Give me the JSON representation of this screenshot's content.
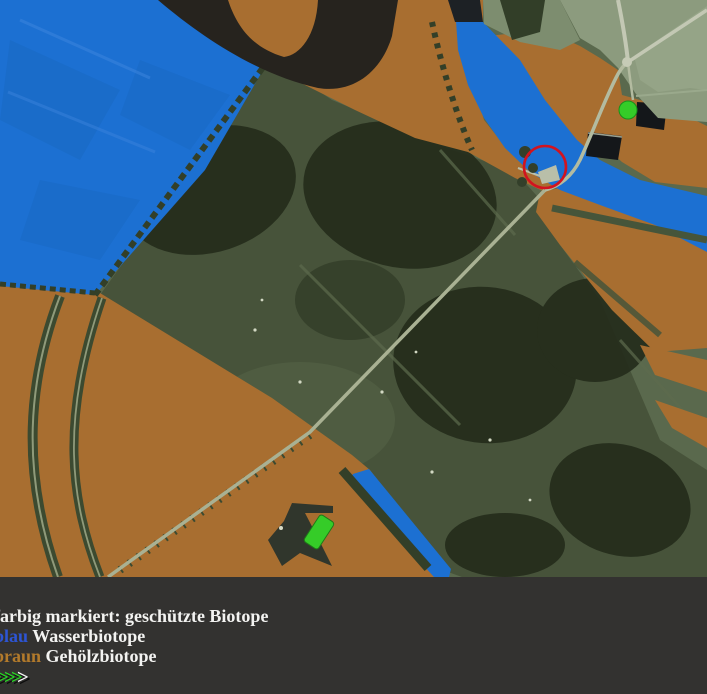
{
  "legend": {
    "title": "farbig markiert: geschützte Biotope",
    "water": {
      "label": "blau",
      "text": "Wasserbiotope"
    },
    "wood": {
      "label": "braun",
      "text": "Gehölzbiotope"
    },
    "arrows": {
      "green": ">>>>",
      "white": ">"
    }
  },
  "colors": {
    "water_overlay": "#1c70d2",
    "wood_overlay": "#a86e30",
    "red_marker": "#d2131f",
    "green_marker": "#35cc28",
    "legend_blue_word": "#2d55d4",
    "legend_brown_word": "#b27a2b",
    "arrow_green": "#2ad426",
    "legend_background": "#333230"
  },
  "markers": {
    "red_circle": "highlighted location (circled in red)",
    "green_dot": "green dot marker",
    "green_bar": "green bar marker"
  }
}
